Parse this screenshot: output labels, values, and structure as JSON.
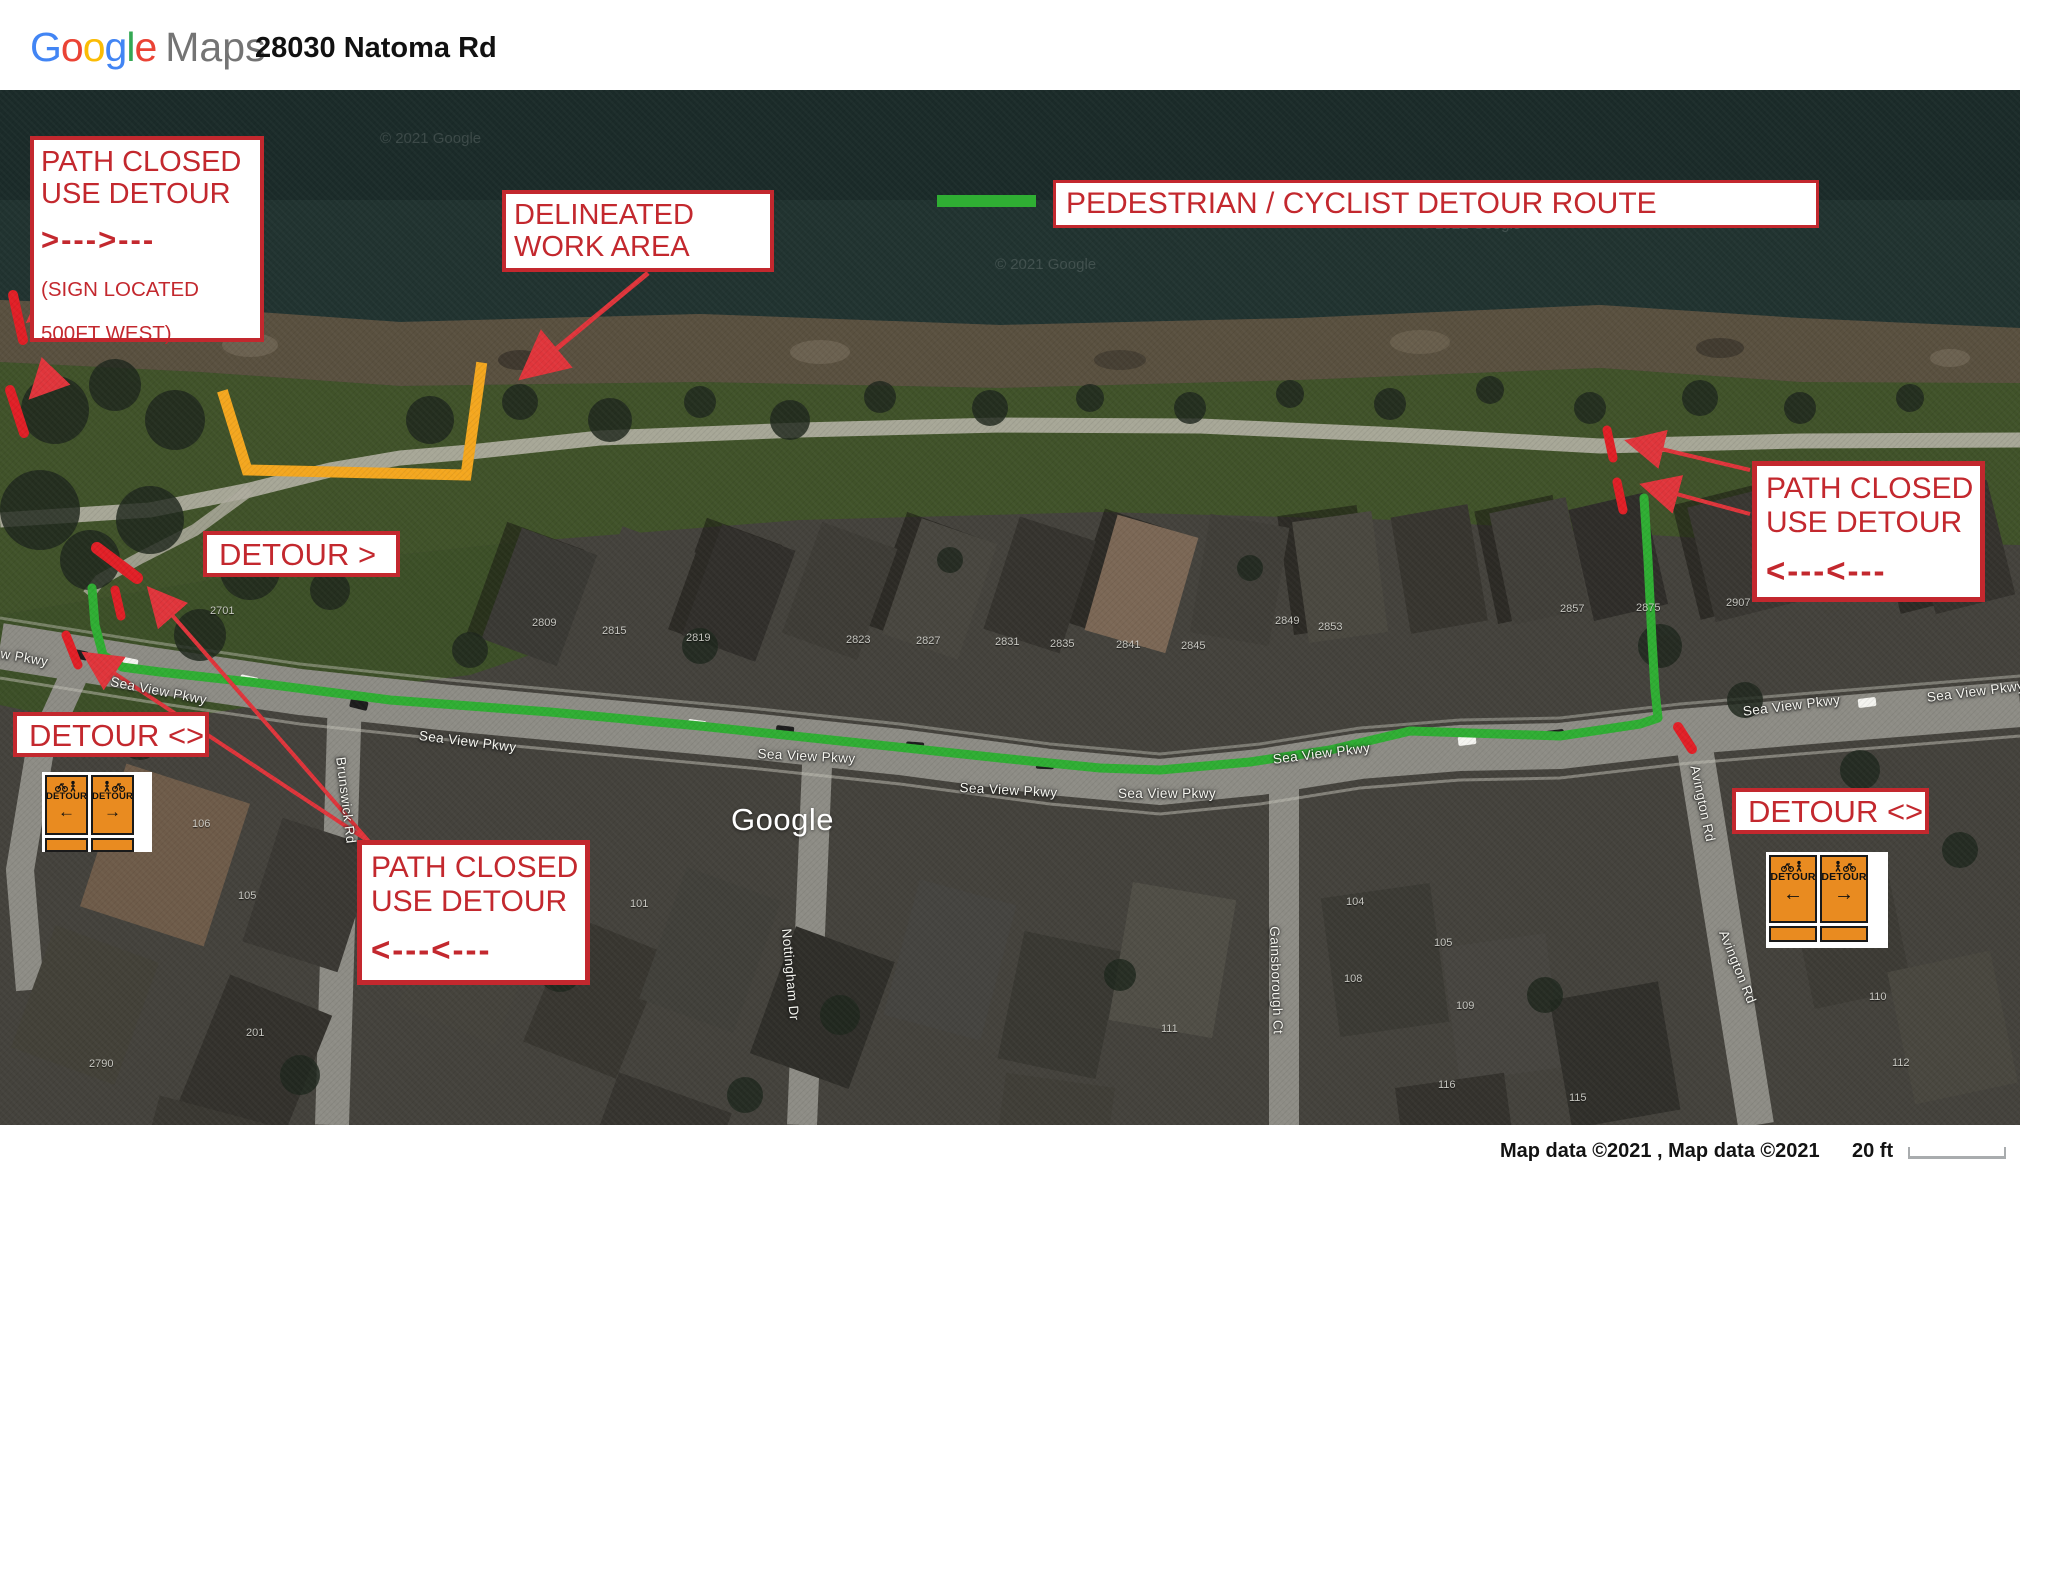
{
  "header": {
    "logo_letters": [
      {
        "ch": "G",
        "color": "#4285F4"
      },
      {
        "ch": "o",
        "color": "#EA4335"
      },
      {
        "ch": "o",
        "color": "#FBBC05"
      },
      {
        "ch": "g",
        "color": "#4285F4"
      },
      {
        "ch": "l",
        "color": "#34A853"
      },
      {
        "ch": "e",
        "color": "#EA4335"
      }
    ],
    "logo_suffix": "Maps",
    "title": "28030 Natoma Rd"
  },
  "annotations": {
    "path_closed_west": {
      "line1": "PATH CLOSED",
      "line2": "USE DETOUR",
      "arrow": ">--->---",
      "note1": "(SIGN LOCATED",
      "note2": "500FT WEST)"
    },
    "work_area": {
      "line1": "DELINEATED",
      "line2": "WORK AREA"
    },
    "legend": {
      "label": "PEDESTRIAN / CYCLIST DETOUR ROUTE"
    },
    "detour_east": "DETOUR >",
    "detour_west": "DETOUR <>",
    "detour_southeast": "DETOUR <>",
    "path_closed_mid": {
      "line1": "PATH CLOSED",
      "line2": "USE DETOUR",
      "arrow": "<---<---"
    },
    "path_closed_east": {
      "line1": "PATH CLOSED",
      "line2": "USE DETOUR",
      "arrow": "<---<---"
    }
  },
  "detour_sign": {
    "label": "DETOUR",
    "left_arrow": "←",
    "right_arrow": "→"
  },
  "map": {
    "google_watermark": "Google",
    "street_labels": [
      {
        "t": "w Pkwy",
        "x": 2,
        "y": 556,
        "r": 10
      },
      {
        "t": "Sea View Pkwy",
        "x": 112,
        "y": 584,
        "r": 11
      },
      {
        "t": "Sea View Pkwy",
        "x": 420,
        "y": 638,
        "r": 7
      },
      {
        "t": "Sea View Pkwy",
        "x": 758,
        "y": 656,
        "r": 3
      },
      {
        "t": "Sea View Pkwy",
        "x": 960,
        "y": 690,
        "r": 3
      },
      {
        "t": "Sea View Pkwy",
        "x": 1118,
        "y": 696,
        "r": 0
      },
      {
        "t": "Sea View Pkwy",
        "x": 1272,
        "y": 662,
        "r": -7
      },
      {
        "t": "Sea View Pkwy",
        "x": 1742,
        "y": 614,
        "r": -7
      },
      {
        "t": "Sea View Pkwy",
        "x": 1926,
        "y": 600,
        "r": -7
      },
      {
        "t": "Brunswick Rd",
        "x": 348,
        "y": 666,
        "r": 83
      },
      {
        "t": "Nottingham Dr",
        "x": 794,
        "y": 838,
        "r": 85
      },
      {
        "t": "Gainsborough Ct",
        "x": 1282,
        "y": 836,
        "r": 88
      },
      {
        "t": "Avington Rd",
        "x": 1702,
        "y": 674,
        "r": 78
      },
      {
        "t": "Avington Rd",
        "x": 1730,
        "y": 838,
        "r": 68
      }
    ],
    "house_numbers": [
      {
        "t": "2701",
        "x": 210,
        "y": 515
      },
      {
        "t": "2809",
        "x": 532,
        "y": 527
      },
      {
        "t": "2815",
        "x": 602,
        "y": 535
      },
      {
        "t": "2819",
        "x": 686,
        "y": 542
      },
      {
        "t": "2823",
        "x": 846,
        "y": 544
      },
      {
        "t": "2827",
        "x": 916,
        "y": 545
      },
      {
        "t": "2831",
        "x": 995,
        "y": 546
      },
      {
        "t": "2835",
        "x": 1050,
        "y": 548
      },
      {
        "t": "2841",
        "x": 1116,
        "y": 549
      },
      {
        "t": "2845",
        "x": 1181,
        "y": 550
      },
      {
        "t": "2849",
        "x": 1275,
        "y": 525
      },
      {
        "t": "2853",
        "x": 1318,
        "y": 531
      },
      {
        "t": "2857",
        "x": 1560,
        "y": 513
      },
      {
        "t": "2875",
        "x": 1636,
        "y": 512
      },
      {
        "t": "2907",
        "x": 1726,
        "y": 507
      },
      {
        "t": "106",
        "x": 192,
        "y": 728
      },
      {
        "t": "105",
        "x": 238,
        "y": 800
      },
      {
        "t": "101",
        "x": 630,
        "y": 808
      },
      {
        "t": "104",
        "x": 1346,
        "y": 806
      },
      {
        "t": "105",
        "x": 1434,
        "y": 847
      },
      {
        "t": "108",
        "x": 1344,
        "y": 883
      },
      {
        "t": "109",
        "x": 1456,
        "y": 910
      },
      {
        "t": "110",
        "x": 1869,
        "y": 901
      },
      {
        "t": "111",
        "x": 1161,
        "y": 933
      },
      {
        "t": "112",
        "x": 1892,
        "y": 967
      },
      {
        "t": "115",
        "x": 1569,
        "y": 1002
      },
      {
        "t": "116",
        "x": 1438,
        "y": 989
      },
      {
        "t": "201",
        "x": 246,
        "y": 937
      },
      {
        "t": "2790",
        "x": 89,
        "y": 968
      }
    ],
    "watermarks": [
      {
        "t": "© 2021 Google",
        "x": 380,
        "y": 40
      },
      {
        "t": "© 2021 Google",
        "x": 995,
        "y": 166
      },
      {
        "t": "© 2021 Google",
        "x": 1420,
        "y": 126
      }
    ]
  },
  "attribution": {
    "text": "Map data ©2021 , Map data ©2021",
    "scale_label": "20 ft"
  },
  "colors": {
    "annotation_red": "#c3282e",
    "closure_bar_red": "#e11f26",
    "arrow_red": "#e0353b",
    "route_green": "#2fae33",
    "work_area_orange": "#f4a71f",
    "sign_orange": "#e98b20",
    "water": "#213330",
    "road_gray": "#8d8c85"
  }
}
